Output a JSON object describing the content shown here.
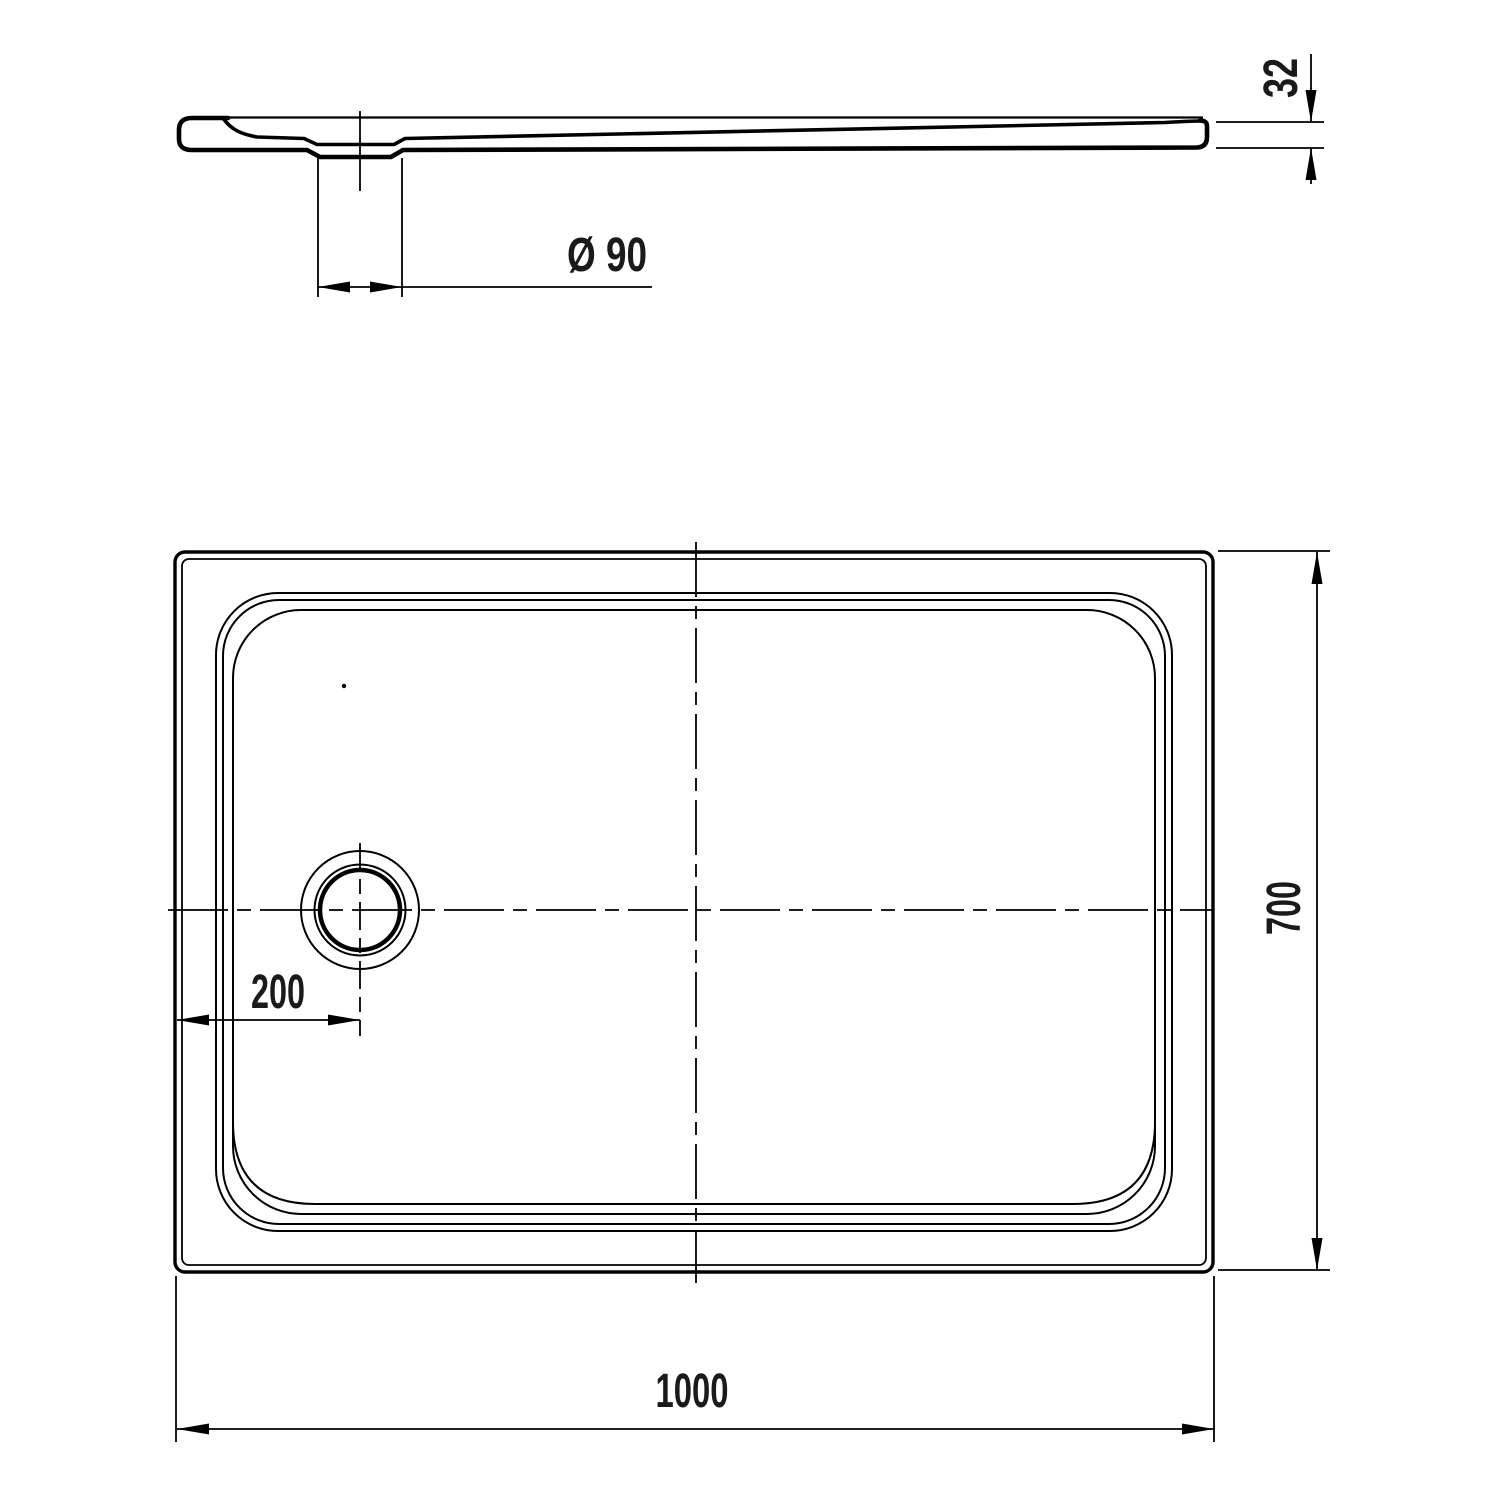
{
  "drawing": {
    "background_color": "#ffffff",
    "line_color": "#000000",
    "dimensions": {
      "thickness": "32",
      "drain_diameter": "Ø 90",
      "drain_offset": "200",
      "depth": "700",
      "width": "1000"
    }
  }
}
